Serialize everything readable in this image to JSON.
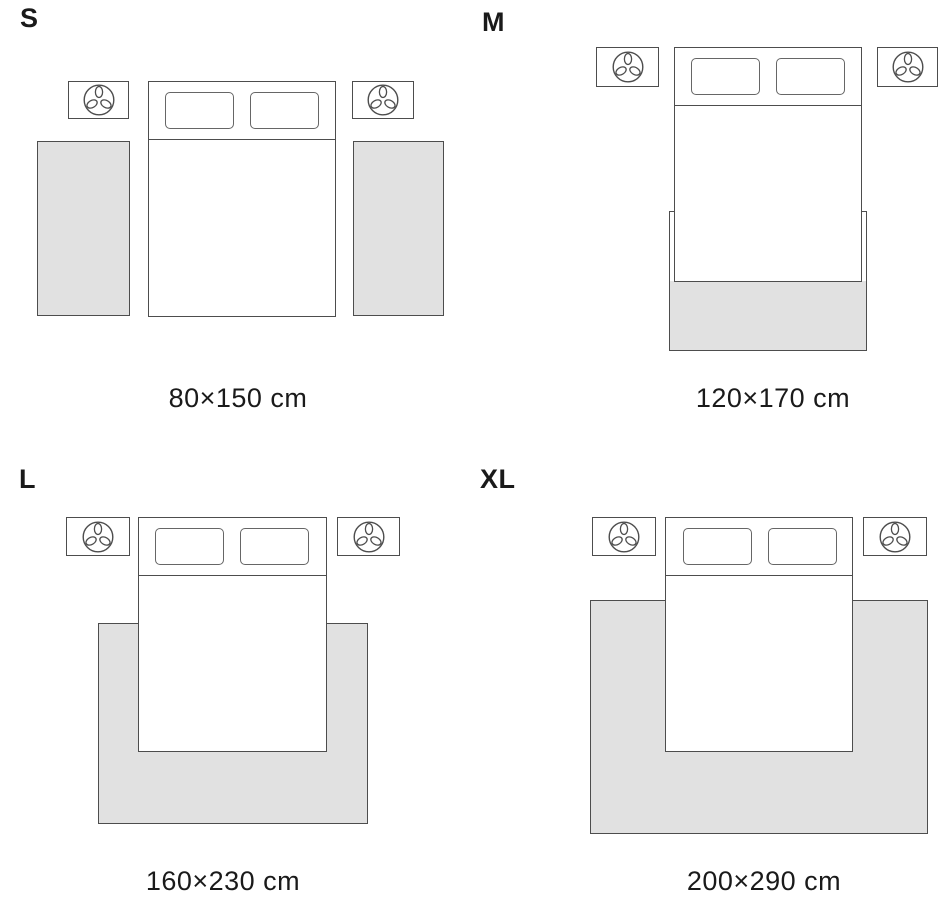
{
  "colors": {
    "outline": "#4d4d4d",
    "rug_fill": "#e1e1e1",
    "text": "#1a1a1a"
  },
  "icons": {
    "nightstand_icon": "plant-icon"
  },
  "panels": {
    "s": {
      "label": "S",
      "size": "80×150 cm"
    },
    "m": {
      "label": "M",
      "size": "120×170 cm"
    },
    "l": {
      "label": "L",
      "size": "160×230 cm"
    },
    "xl": {
      "label": "XL",
      "size": "200×290 cm"
    }
  }
}
